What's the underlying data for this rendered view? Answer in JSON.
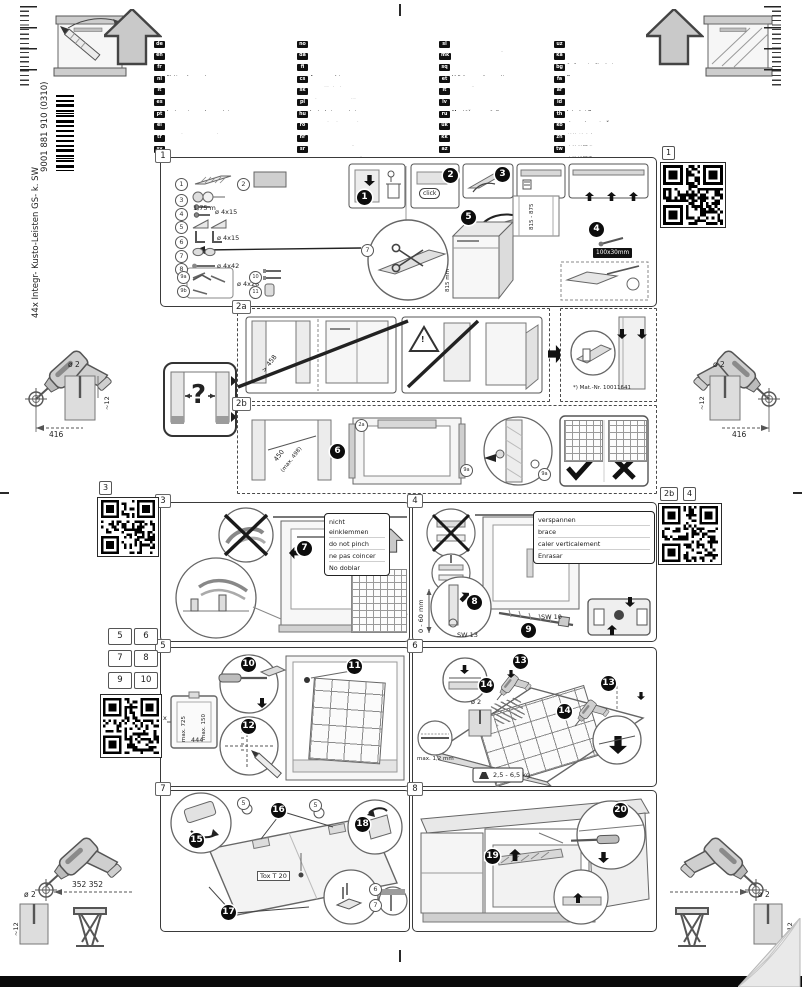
{
  "page": {
    "code": "9001 881 910  (0310)",
    "product": "44x Integr- Kusto-Leisten GS- k. SW"
  },
  "languages": {
    "columns": [
      [
        {
          "code": "de",
          "title": "Montageanleitung",
          "note": "*über Kundendienst erhältlich"
        },
        {
          "code": "en",
          "title": "Installation instructions",
          "note": "*Available from customer service"
        },
        {
          "code": "fr",
          "title": "Notice de montage",
          "note": "*Disponible par le biais du service après-vente"
        },
        {
          "code": "nl",
          "title": "Montagevoorschrift",
          "note": "*Tegen meerprijs bij de Servicedienst verkrijgbaar"
        },
        {
          "code": "it",
          "title": "Istruzioni per il montaggio",
          "note": "*Disponibili presso il servizio assistenza clienti"
        },
        {
          "code": "es",
          "title": "Instrucciones de montaje",
          "note": "*(Se puede adquirir a través del Servicio de Asistencia Técnica Oficial de la marca)"
        },
        {
          "code": "pt",
          "title": "Instruções de montagem",
          "note": "*Podem ser adquiridas nos nossos Serviços Técnicos"
        },
        {
          "code": "el",
          "title": "Οδηγίες συναρμολόγησης",
          "note": "*Διατίθενται από την υπηρεσία εξυπηρέτησης πελατών"
        },
        {
          "code": "tr",
          "title": "Montaj kılavuzu",
          "note": "*Yetkili servis üzerinden alınabilir"
        },
        {
          "code": "sv",
          "title": "Monteringsanvisning",
          "note": "*Kan fås via Service"
        }
      ],
      [
        {
          "code": "no",
          "title": "Monteringsanvisning",
          "note": "*fåes hos kundeservice"
        },
        {
          "code": "da",
          "title": "Monteringsvejledning",
          "note": "*Kan købes hos serviceafdelingen"
        },
        {
          "code": "fi",
          "title": "Asennusohje",
          "note": "*Saatavissa huoltopalvelusta"
        },
        {
          "code": "cs",
          "title": "Montážní návod",
          "note": "*K dispozici přes servisní službu"
        },
        {
          "code": "sk",
          "title": "Návod na montáž",
          "note": "*Dostanete v službe zákazníkom"
        },
        {
          "code": "pl",
          "title": "Instrukcja montażu",
          "note": "*Do uzyskania w punkcie serwisowym"
        },
        {
          "code": "hu",
          "title": "Szerelési útmutató",
          "note": "*A vevőszolgálaton keresztül kapható"
        },
        {
          "code": "ro",
          "title": "Instrucţiune de montaj",
          "note": "*obtenabilă la service (pentru clienţi)"
        },
        {
          "code": "hr",
          "title": "Upute za montažu",
          "note": "*može dobiti kod službe održavanja"
        },
        {
          "code": "sr",
          "title": "Uputstvo za montažu",
          "note": "*Može se nabaviti preko servisne službe"
        }
      ],
      [
        {
          "code": "sl",
          "title": "Navodilo za montažo",
          "note": "*Lahko dobite v servisni službi"
        },
        {
          "code": "mk",
          "title": "Упатства за монтажа",
          "note": "*се добива преку службата за купувачи"
        },
        {
          "code": "sq",
          "title": "Udhëzues për montim",
          "note": "*gjendet nëpërmjet servisit"
        },
        {
          "code": "et",
          "title": "Montaažijuhend",
          "note": "*saab klienditeenindusest"
        },
        {
          "code": "lt",
          "title": "Montavimo instrukcija",
          "note": "*galima gauti klientų aptarnavimo servise"
        },
        {
          "code": "lv",
          "title": "Montāžas pamācība",
          "note": "*var saņemt servisa dienestā"
        },
        {
          "code": "ru",
          "title": "Инструкция по монтажу",
          "note": "*можно получить в сервисном центре"
        },
        {
          "code": "uk",
          "title": "Інструкція з монтажу",
          "note": "*можна отримати через сервісну службу"
        },
        {
          "code": "kk",
          "title": "Монтаждау нұсқаулығы",
          "note": "*сервис қызметі арқылы алуға болады"
        },
        {
          "code": "az",
          "title": "Quraşdırma təlimatları",
          "note": "*müştəri xidmətlərindən əldə oluna bilər"
        }
      ],
      [
        {
          "code": "uz",
          "title": "O'rnatish yo'riqnomasi",
          "note": "*mijozlarga xizmat ko'rsatish markazida mavjud"
        },
        {
          "code": "ka",
          "title": "მონტაჟის ინსტრუქცია",
          "note": "*შეგიძლიათ მიიღოთ სერვისცენტრში"
        },
        {
          "code": "bg",
          "title": "Ръководство за монтаж",
          "note": "*предоставя се от сервиза за обслужване на клиенти"
        },
        {
          "code": "fa",
          "title": "دستورالعمل نصب",
          "note": "*از خدمات پس از فروش قابل تهیه است"
        },
        {
          "code": "ar",
          "title": "تعليمات التركيب",
          "note": "*متوفرة لدى مركز خدمة العملاء"
        },
        {
          "code": "id",
          "title": "Intruksi Pemasangan",
          "note": "*bisa didapatkan melalui Customer Service"
        },
        {
          "code": "th",
          "title": "คำแนะนำการติดตั้ง",
          "note": "*ขอรับได้จากฝ่ายบริการลูกค้า"
        },
        {
          "code": "ko",
          "title": "설치 설명서",
          "note": "*고객서비스 센터에서 구입 가능"
        },
        {
          "code": "zh",
          "title": "安装说明书",
          "note": "*可向售后服务部门索取"
        },
        {
          "code": "tw",
          "title": "安裝說明書",
          "note": "*可經由客戶服務單位索取"
        }
      ]
    ]
  },
  "panel1": {
    "label": "1",
    "parts": [
      {
        "n": "1",
        "icon": "strip",
        "note": ""
      },
      {
        "n": "2",
        "icon": "panel",
        "note": ""
      },
      {
        "n": "3",
        "icon": "tape",
        "note": "1,75 m"
      },
      {
        "n": "4",
        "icon": "screws",
        "note": "ø 4x15"
      },
      {
        "n": "5",
        "icon": "wedges",
        "note": ""
      },
      {
        "n": "6",
        "icon": "brackets",
        "note": "ø 4x15"
      },
      {
        "n": "7",
        "icon": "clips",
        "note": ""
      },
      {
        "n": "8",
        "icon": "screw",
        "note": "ø 4x42"
      },
      {
        "n": "9a",
        "icon": "",
        "note": ""
      },
      {
        "n": "9b",
        "icon": "kit",
        "note": "ø 4x28"
      },
      {
        "n": "10",
        "icon": "pins",
        "note": ""
      },
      {
        "n": "11",
        "icon": "cap",
        "note": ""
      }
    ],
    "steps": [
      "1",
      "2",
      "3",
      "4",
      "5"
    ],
    "click": "click",
    "strip_size": "100x30mm",
    "niche_height": "815 - 875",
    "appliance_height": "815 mm",
    "callout7": "7"
  },
  "panel2a": {
    "label": "2a",
    "min_width": "> 458",
    "warning": "!",
    "mat_nr": "*) Mat.-Nr. 10011641"
  },
  "question_box": {
    "mark": "?"
  },
  "panel2b": {
    "label": "2b",
    "step": "6",
    "width": "450",
    "width_max": "(max. 498)",
    "callout_2a": "2a",
    "callout_9a": "9a",
    "icons": [
      "check",
      "cross"
    ]
  },
  "panel3": {
    "label": "3",
    "step": "7",
    "notes": [
      "nicht einklemmen",
      "do not pinch",
      "ne pas coincer",
      "No doblar"
    ]
  },
  "panel4": {
    "label": "4",
    "steps": [
      "8",
      "9"
    ],
    "notes": [
      "verspannen",
      "brace",
      "caler verticalement",
      "Enrasar"
    ],
    "range": "0 - 60 mm",
    "sw13": "SW 13",
    "sw10": "SW 10"
  },
  "panel5": {
    "label": "5",
    "steps": [
      "10",
      "11",
      "12"
    ],
    "max_side": "max. 725",
    "max_top": "max. 150",
    "width": "444",
    "x_dim": "x"
  },
  "panel6": {
    "label": "6",
    "steps": [
      "13",
      "14"
    ],
    "drill_dia": "ø 2",
    "max_gap": "max. 1,2 mm",
    "weight": "2,5 - 6,5 kg"
  },
  "panel7": {
    "label": "7",
    "steps": [
      "15",
      "16",
      "17",
      "18"
    ],
    "torx": "Tox T 20",
    "callouts": [
      "5",
      "6",
      "7"
    ]
  },
  "panel8": {
    "label": "8",
    "steps": [
      "19",
      "20"
    ]
  },
  "margins": {
    "qr_top_right_label": "1",
    "qr_left_label": "3",
    "qr_right_label_a": "2b",
    "qr_right_label_b": "4",
    "page_refs": [
      "5",
      "6",
      "7",
      "8",
      "9",
      "10"
    ],
    "drill_dia": "ø 2",
    "drill_depth": "~12",
    "dist_mid": "416",
    "dist_bottom": "352 352"
  }
}
